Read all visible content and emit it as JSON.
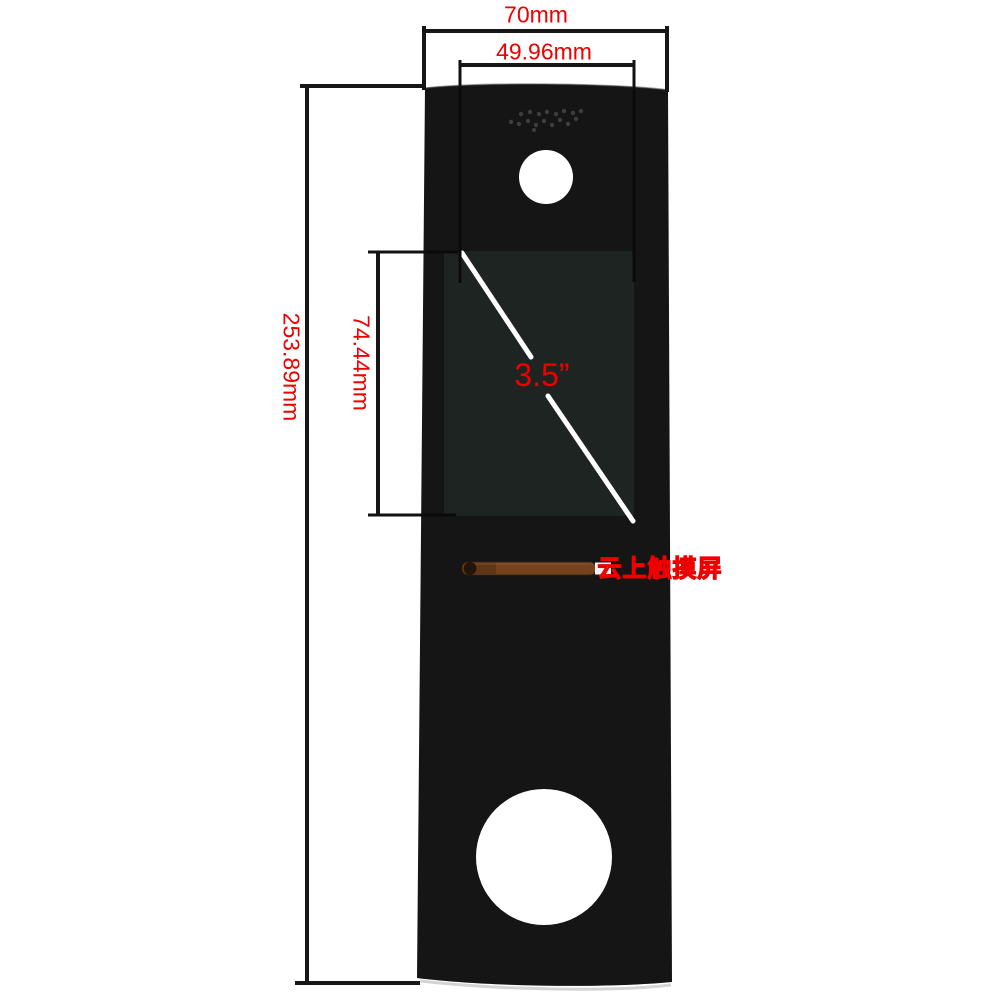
{
  "labels": {
    "outer_width": "70mm",
    "screen_width": "49.96mm",
    "panel_height": "253.89mm",
    "screen_height": "74.44mm",
    "screen_diagonal": "3.5”",
    "watermark": "云上触摸屏"
  },
  "colors": {
    "annotation_red": "#ee0000",
    "panel_black": "#151515",
    "display_gray": "#1e2421",
    "dimension_line": "#161616",
    "cable_copper": "#76431f"
  }
}
